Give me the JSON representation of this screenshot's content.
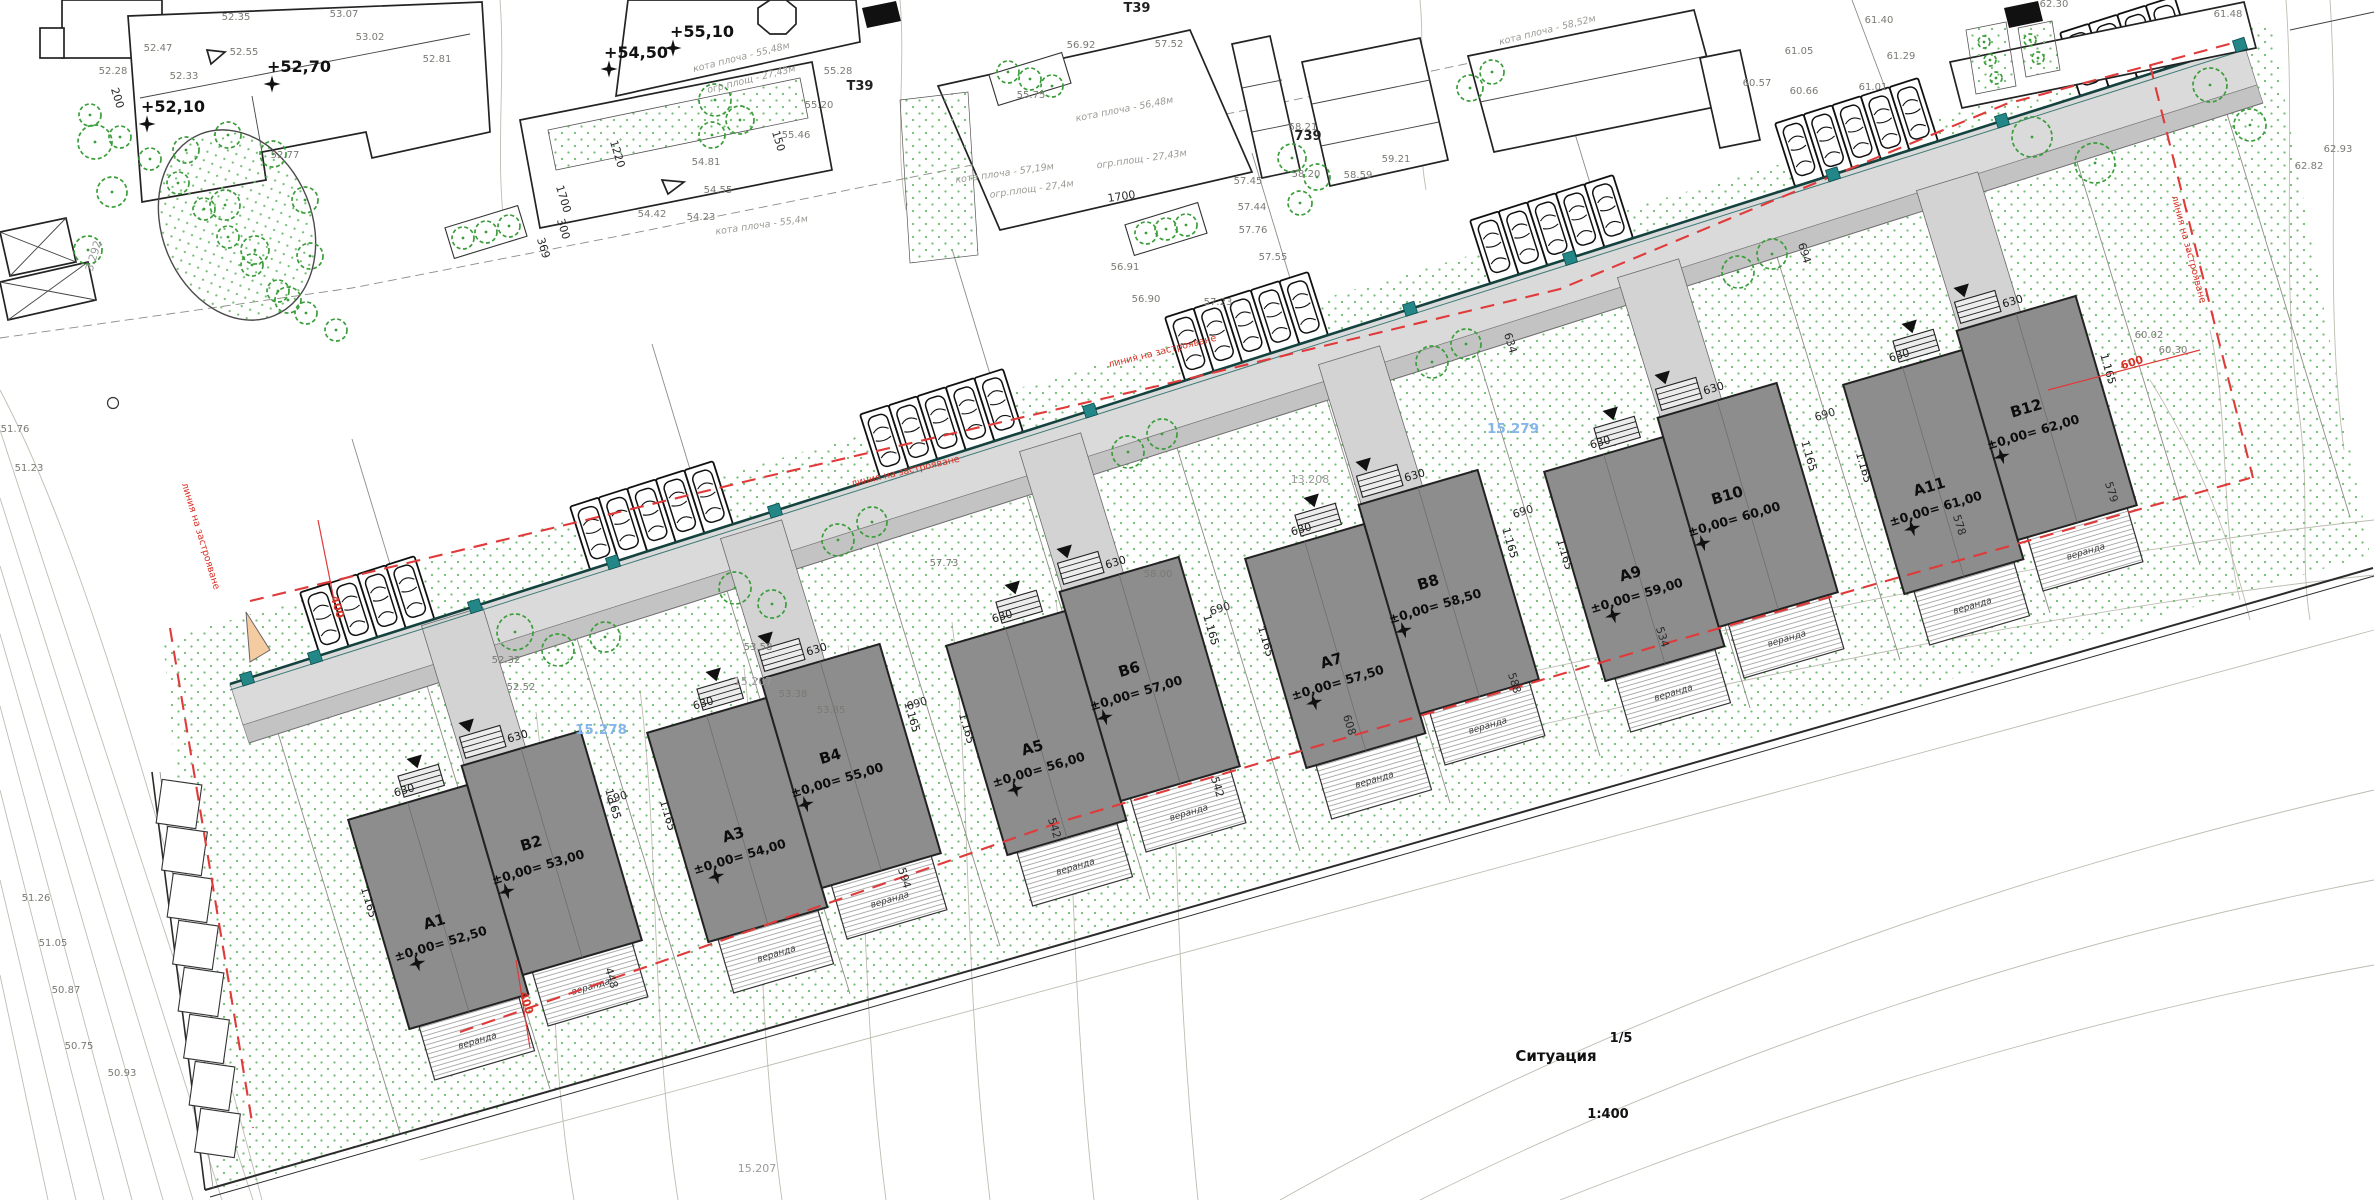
{
  "title_block": {
    "name": "Ситуация",
    "scale": "1:400",
    "sheet": "1/5"
  },
  "notes": {
    "building_line": "линия на застрояване",
    "veranda": "веранда"
  },
  "dims_shared": {
    "half_width": "630",
    "depth": "1.165"
  },
  "buildings": [
    {
      "a_id": "A1",
      "a_elev": "±0,00= 52,50",
      "b_id": "B2",
      "b_elev": "±0,00= 53,00",
      "cx": 495,
      "cy": 880
    },
    {
      "a_id": "A3",
      "a_elev": "±0,00= 54,00",
      "b_id": "B4",
      "b_elev": "±0,00= 55,00",
      "cx": 794,
      "cy": 793
    },
    {
      "a_id": "A5",
      "a_elev": "±0,00= 56,00",
      "b_id": "B6",
      "b_elev": "±0,00= 57,00",
      "cx": 1093,
      "cy": 706
    },
    {
      "a_id": "A7",
      "a_elev": "±0,00= 57,50",
      "b_id": "B8",
      "b_elev": "±0,00= 58,50",
      "cx": 1392,
      "cy": 619
    },
    {
      "a_id": "A9",
      "a_elev": "±0,00= 59,00",
      "b_id": "B10",
      "b_elev": "±0,00= 60,00",
      "cx": 1691,
      "cy": 532
    },
    {
      "a_id": "A11",
      "a_elev": "±0,00= 61,00",
      "b_id": "B12",
      "b_elev": "±0,00= 62,00",
      "cx": 1990,
      "cy": 445
    }
  ],
  "parking": [
    {
      "x": 320,
      "count": 4
    },
    {
      "x": 590,
      "count": 5
    },
    {
      "x": 880,
      "count": 5
    },
    {
      "x": 1185,
      "count": 5
    },
    {
      "x": 1490,
      "count": 5
    },
    {
      "x": 1795,
      "count": 5
    },
    {
      "x": 2080,
      "count": 4
    }
  ],
  "wall_squares": [
    247,
    315,
    475,
    613,
    775,
    1090,
    1410,
    1570,
    1833,
    2002,
    2240
  ],
  "benchmarks": [
    [
      147,
      124
    ],
    [
      272,
      84
    ],
    [
      609,
      69
    ],
    [
      673,
      48
    ]
  ],
  "trees": [
    [
      95,
      142,
      17
    ],
    [
      112,
      192,
      15
    ],
    [
      88,
      250,
      14
    ],
    [
      305,
      200,
      13
    ],
    [
      310,
      256,
      13
    ],
    [
      288,
      300,
      13
    ],
    [
      228,
      135,
      13
    ],
    [
      273,
      154,
      13
    ],
    [
      186,
      150,
      13
    ],
    [
      225,
      205,
      15
    ],
    [
      255,
      250,
      14
    ],
    [
      90,
      115,
      11
    ],
    [
      120,
      137,
      11
    ],
    [
      150,
      159,
      11
    ],
    [
      178,
      183,
      11
    ],
    [
      204,
      209,
      11
    ],
    [
      228,
      237,
      11
    ],
    [
      252,
      265,
      11
    ],
    [
      278,
      291,
      11
    ],
    [
      306,
      313,
      11
    ],
    [
      336,
      330,
      11
    ],
    [
      515,
      632,
      18
    ],
    [
      558,
      650,
      16
    ],
    [
      605,
      637,
      15
    ],
    [
      735,
      588,
      16
    ],
    [
      772,
      604,
      14
    ],
    [
      838,
      540,
      16
    ],
    [
      872,
      522,
      15
    ],
    [
      1128,
      452,
      16
    ],
    [
      1162,
      434,
      15
    ],
    [
      1432,
      362,
      16
    ],
    [
      1466,
      344,
      15
    ],
    [
      1738,
      272,
      16
    ],
    [
      1772,
      254,
      15
    ],
    [
      2032,
      137,
      20
    ],
    [
      2095,
      163,
      20
    ],
    [
      2210,
      85,
      17
    ],
    [
      2250,
      125,
      16
    ],
    [
      715,
      100,
      16
    ],
    [
      740,
      120,
      14
    ],
    [
      712,
      135,
      13
    ],
    [
      1292,
      158,
      14
    ],
    [
      1317,
      177,
      13
    ],
    [
      1300,
      203,
      12
    ],
    [
      1470,
      88,
      13
    ],
    [
      1492,
      72,
      12
    ],
    [
      1008,
      72,
      11
    ],
    [
      1030,
      79,
      11
    ],
    [
      1052,
      86,
      11
    ],
    [
      1146,
      233,
      11
    ],
    [
      1166,
      229,
      11
    ],
    [
      1186,
      225,
      11
    ],
    [
      463,
      238,
      11
    ],
    [
      486,
      232,
      11
    ],
    [
      509,
      226,
      11
    ],
    [
      1984,
      42,
      6
    ],
    [
      1990,
      60,
      6
    ],
    [
      1996,
      78,
      6
    ],
    [
      2030,
      40,
      6
    ],
    [
      2038,
      58,
      6
    ]
  ],
  "labels": [
    [
      "+52,10",
      173,
      112,
      0,
      "bm"
    ],
    [
      "+52,70",
      299,
      72,
      0,
      "bm"
    ],
    [
      "+54,50",
      636,
      58,
      0,
      "bm"
    ],
    [
      "+55,10",
      702,
      37,
      0,
      "bm"
    ],
    [
      "52.35",
      236,
      20,
      0,
      "sp"
    ],
    [
      "53.07",
      344,
      17,
      0,
      "sp"
    ],
    [
      "53.02",
      370,
      40,
      0,
      "sp"
    ],
    [
      "52.47",
      158,
      51,
      0,
      "sp"
    ],
    [
      "52.28",
      113,
      74,
      0,
      "sp"
    ],
    [
      "52.33",
      184,
      79,
      0,
      "sp"
    ],
    [
      "52.55",
      244,
      55,
      0,
      "sp"
    ],
    [
      "52.77",
      285,
      158,
      0,
      "sp"
    ],
    [
      "52.81",
      437,
      62,
      0,
      "sp"
    ],
    [
      "54.81",
      706,
      165,
      0,
      "sp"
    ],
    [
      "54.55",
      718,
      193,
      0,
      "sp"
    ],
    [
      "54.42",
      652,
      217,
      0,
      "sp"
    ],
    [
      "54.23",
      701,
      220,
      0,
      "sp"
    ],
    [
      "55.20",
      819,
      108,
      0,
      "sp"
    ],
    [
      "55.46",
      796,
      138,
      0,
      "sp"
    ],
    [
      "55.28",
      838,
      74,
      0,
      "sp"
    ],
    [
      "56.92",
      1081,
      48,
      0,
      "sp"
    ],
    [
      "57.52",
      1169,
      47,
      0,
      "sp"
    ],
    [
      "55.75",
      1031,
      98,
      0,
      "sp"
    ],
    [
      "57.45",
      1248,
      184,
      0,
      "sp"
    ],
    [
      "57.44",
      1252,
      210,
      0,
      "sp"
    ],
    [
      "57.76",
      1253,
      233,
      0,
      "sp"
    ],
    [
      "57.55",
      1273,
      260,
      0,
      "sp"
    ],
    [
      "58.21",
      1303,
      130,
      0,
      "sp"
    ],
    [
      "58.20",
      1306,
      177,
      0,
      "sp"
    ],
    [
      "58.59",
      1358,
      178,
      0,
      "sp"
    ],
    [
      "59.21",
      1396,
      162,
      0,
      "sp"
    ],
    [
      "56.91",
      1125,
      270,
      0,
      "sp"
    ],
    [
      "56.90",
      1146,
      302,
      0,
      "sp"
    ],
    [
      "57.23",
      1218,
      305,
      0,
      "sp"
    ],
    [
      "60.57",
      1757,
      86,
      0,
      "sp"
    ],
    [
      "60.66",
      1804,
      94,
      0,
      "sp"
    ],
    [
      "61.01",
      1873,
      90,
      0,
      "sp"
    ],
    [
      "61.05",
      1799,
      54,
      0,
      "sp"
    ],
    [
      "61.29",
      1901,
      59,
      0,
      "sp"
    ],
    [
      "61.40",
      1879,
      23,
      0,
      "sp"
    ],
    [
      "62.30",
      2054,
      7,
      0,
      "sp"
    ],
    [
      "61.48",
      2228,
      17,
      0,
      "sp"
    ],
    [
      "62.82",
      2309,
      169,
      0,
      "sp"
    ],
    [
      "62.93",
      2338,
      152,
      0,
      "sp"
    ],
    [
      "60.02",
      2149,
      338,
      0,
      "sp"
    ],
    [
      "60.30",
      2173,
      353,
      0,
      "sp"
    ],
    [
      "57.73",
      944,
      566,
      0,
      "sp"
    ],
    [
      "58.00",
      1158,
      577,
      0,
      "sp"
    ],
    [
      "53.58",
      758,
      650,
      0,
      "sp"
    ],
    [
      "53.38",
      793,
      697,
      0,
      "sp"
    ],
    [
      "53.85",
      831,
      713,
      0,
      "sp"
    ],
    [
      "52.32",
      506,
      663,
      0,
      "sp"
    ],
    [
      "52.52",
      521,
      690,
      0,
      "sp"
    ],
    [
      "51.26",
      36,
      901,
      0,
      "sp"
    ],
    [
      "51.05",
      53,
      946,
      0,
      "sp"
    ],
    [
      "50.87",
      66,
      993,
      0,
      "sp"
    ],
    [
      "50.75",
      79,
      1049,
      0,
      "sp"
    ],
    [
      "50.93",
      122,
      1076,
      0,
      "sp"
    ],
    [
      "51.76",
      15,
      432,
      0,
      "sp"
    ],
    [
      "51.23",
      29,
      471,
      0,
      "sp"
    ],
    [
      "15.207",
      753,
      685,
      0,
      "par"
    ],
    [
      "15.207",
      757,
      1172,
      0,
      "par"
    ],
    [
      "13.208",
      1310,
      483,
      0,
      "par"
    ],
    [
      "3.292",
      97,
      257,
      -73,
      "par"
    ],
    [
      "15.278",
      601,
      734,
      0,
      "blue"
    ],
    [
      "15.279",
      1513,
      433,
      0,
      "blue"
    ],
    [
      "кота плоча - 55,48м",
      742,
      60,
      -14,
      "kt"
    ],
    [
      "огр.площ - 27,43м",
      752,
      82,
      -14,
      "kt"
    ],
    [
      "кота плоча - 57,19м",
      1005,
      176,
      -8,
      "kt"
    ],
    [
      "огр.площ - 27,4м",
      1032,
      192,
      -8,
      "kt"
    ],
    [
      "огр.площ - 27,43м",
      1142,
      162,
      -8,
      "kt"
    ],
    [
      "кота плоча - 56,48м",
      1125,
      112,
      -11,
      "kt"
    ],
    [
      "кота плоча - 58,52м",
      1548,
      33,
      -14,
      "kt"
    ],
    [
      "кота плоча - 55,4м",
      762,
      228,
      -8,
      "kt"
    ],
    [
      "Т39",
      860,
      90,
      0,
      "t39"
    ],
    [
      "Т39",
      1137,
      12,
      0,
      "t39"
    ],
    [
      "739",
      1308,
      140,
      0,
      "t39"
    ],
    [
      "200",
      114,
      99,
      73,
      "dim"
    ],
    [
      "150",
      775,
      142,
      73,
      "dim"
    ],
    [
      "1700",
      560,
      200,
      73,
      "dim"
    ],
    [
      "1220",
      614,
      155,
      73,
      "dim"
    ],
    [
      "300",
      560,
      230,
      73,
      "dim"
    ],
    [
      "369",
      540,
      249,
      73,
      "dim"
    ],
    [
      "1700",
      1122,
      200,
      -8,
      "dim"
    ],
    [
      "690",
      618,
      801,
      -17,
      "dim"
    ],
    [
      "690",
      918,
      707,
      -17,
      "dim"
    ],
    [
      "690",
      1221,
      612,
      -17,
      "dim"
    ],
    [
      "690",
      1524,
      515,
      -17,
      "dim"
    ],
    [
      "690",
      1826,
      418,
      -17,
      "dim"
    ],
    [
      "634",
      1507,
      344,
      73,
      "dim"
    ],
    [
      "694",
      1801,
      254,
      73,
      "dim"
    ],
    [
      "448",
      608,
      979,
      73,
      "dim"
    ],
    [
      "594",
      901,
      879,
      73,
      "dim"
    ],
    [
      "542",
      1214,
      788,
      73,
      "dim"
    ],
    [
      "542",
      1051,
      829,
      73,
      "dim"
    ],
    [
      "534",
      1659,
      638,
      73,
      "dim"
    ],
    [
      "588",
      1511,
      684,
      73,
      "dim"
    ],
    [
      "608",
      1346,
      726,
      73,
      "dim"
    ],
    [
      "579",
      2108,
      493,
      73,
      "dim"
    ],
    [
      "578",
      1956,
      526,
      73,
      "dim"
    ],
    [
      "400",
      334,
      608,
      73,
      "dimr"
    ],
    [
      "400",
      523,
      1004,
      73,
      "dimr"
    ],
    [
      "600",
      2133,
      366,
      -17,
      "dimr"
    ],
    [
      "линия на застрояване",
      1163,
      354,
      -14,
      "rl"
    ],
    [
      "линия на застрояване",
      906,
      474,
      -13,
      "rl"
    ],
    [
      "линия на застрояване",
      198,
      537,
      73,
      "rl"
    ],
    [
      "линия на застрояване",
      2186,
      250,
      75,
      "rl"
    ]
  ]
}
